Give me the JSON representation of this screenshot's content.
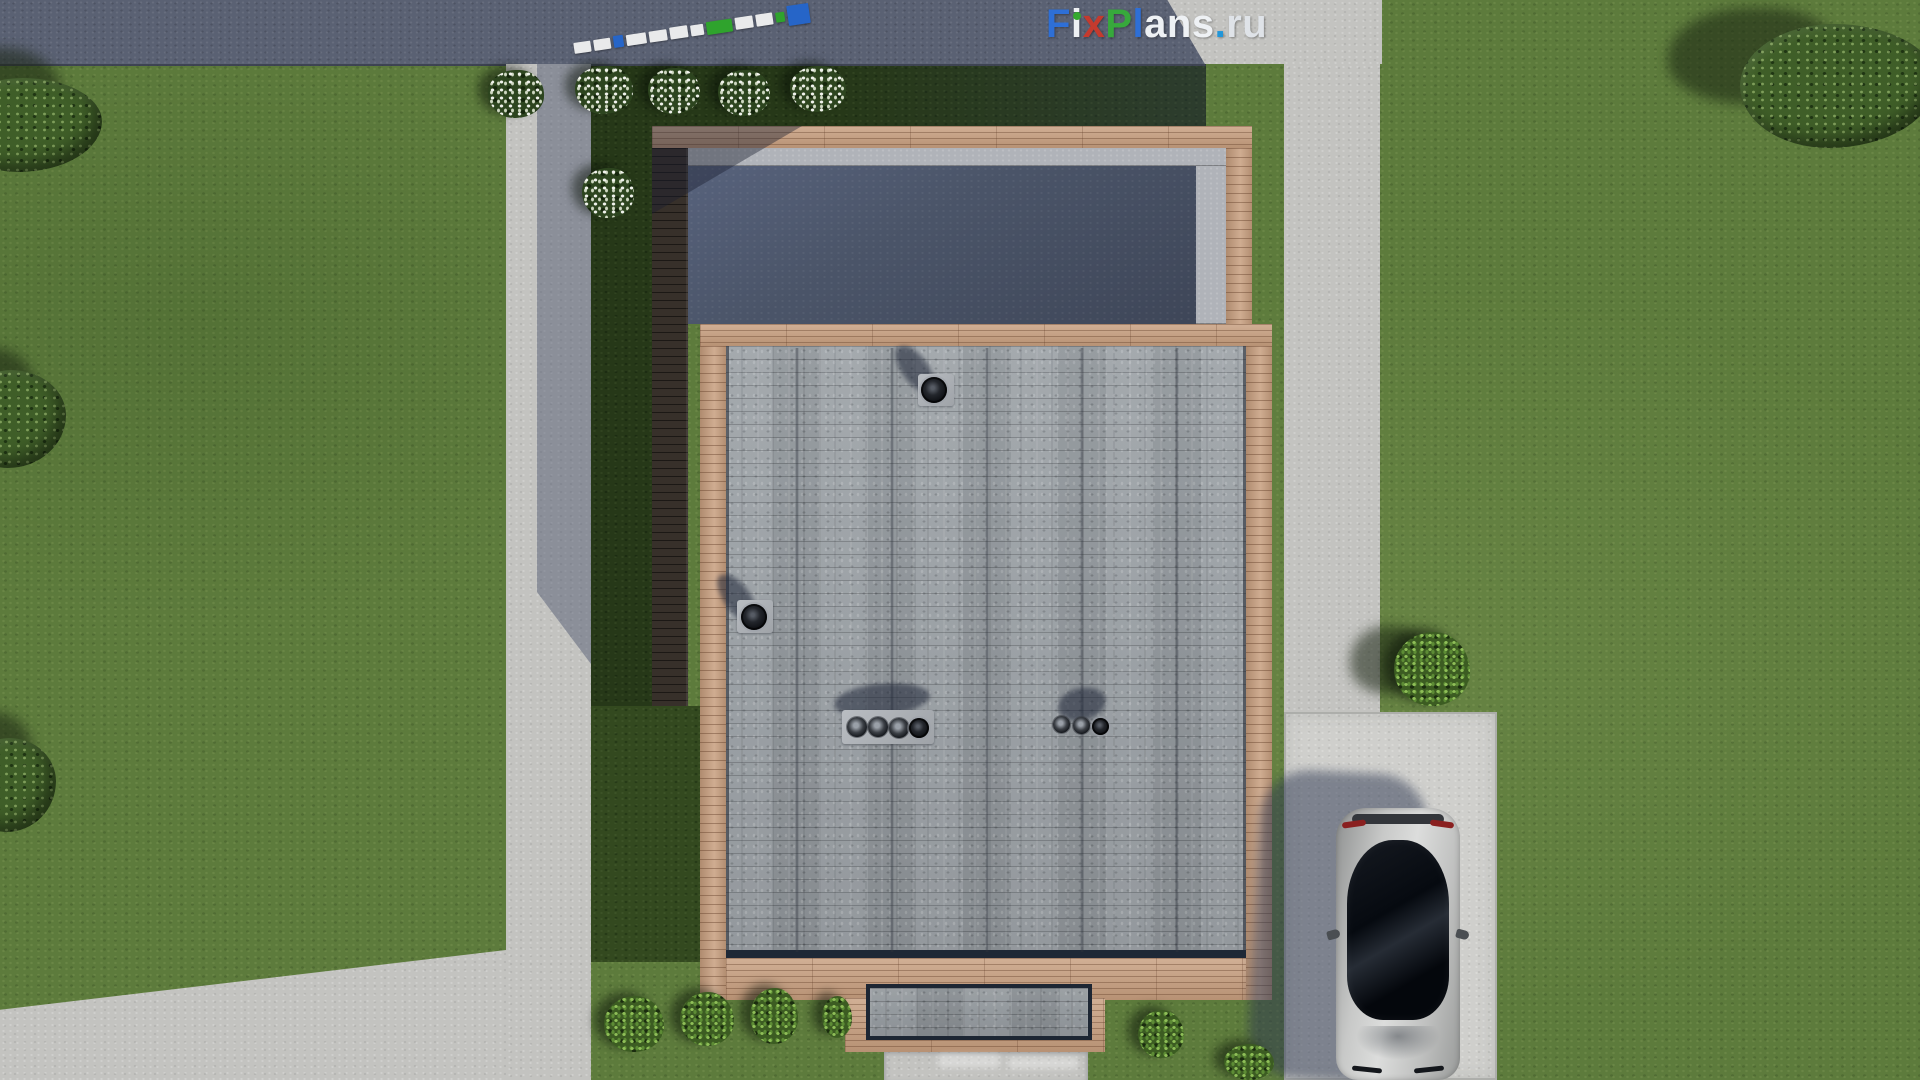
{
  "logo": {
    "text": "FixPlans.ru",
    "letters": [
      {
        "ch": "F",
        "color": "#2e6fd6"
      },
      {
        "ch": "i",
        "color": "#eef1f4"
      },
      {
        "ch": "x",
        "color": "#c43a2e"
      },
      {
        "ch": "P",
        "color": "#37a93c"
      },
      {
        "ch": "l",
        "color": "#2e6fd6"
      },
      {
        "ch": "a",
        "color": "#eef1f4"
      },
      {
        "ch": "n",
        "color": "#eef1f4"
      },
      {
        "ch": "s",
        "color": "#eef1f4"
      },
      {
        "ch": ".",
        "color": "#2196d9"
      },
      {
        "ch": "r",
        "color": "#dfe3e8"
      },
      {
        "ch": "u",
        "color": "#dfe3e8"
      }
    ],
    "i_dot_color": "#35a92f"
  },
  "palette": {
    "grass": "#5d7b3c",
    "grass-bed": "#263818",
    "grass-bed2": "#33491f",
    "road": "#5a6173",
    "pavement": "#c3c3c0",
    "driveway": "#cfcfcc",
    "wood": "#c79e7e",
    "wood-dark": "#37302a",
    "membrane-a": "#57627c",
    "membrane-b": "#3e4658",
    "parapet": "#b0b3b9",
    "shingle": "#9aa0a5",
    "roof-border": "#1e2836"
  },
  "scene": {
    "description": "Top-down 3D site render: house with gray shingle roof and dark flat roof, wood trim, lawn, concrete paths, driveway with parked silver car",
    "markers": [
      {
        "w": 17,
        "h": 11,
        "color": "#e9eaeb"
      },
      {
        "w": 17,
        "h": 11,
        "color": "#e9eaeb"
      },
      {
        "w": 10,
        "h": 12,
        "color": "#2665c8"
      },
      {
        "w": 20,
        "h": 11,
        "color": "#e9eaeb"
      },
      {
        "w": 18,
        "h": 11,
        "color": "#e9eaeb"
      },
      {
        "w": 18,
        "h": 12,
        "color": "#e9eaeb"
      },
      {
        "w": 13,
        "h": 11,
        "color": "#e9eaeb"
      },
      {
        "w": 26,
        "h": 13,
        "color": "#2fa32d"
      },
      {
        "w": 18,
        "h": 12,
        "color": "#e9eaeb"
      },
      {
        "w": 17,
        "h": 12,
        "color": "#e9eaeb"
      },
      {
        "w": 9,
        "h": 10,
        "color": "#2fa32d"
      },
      {
        "w": 22,
        "h": 20,
        "color": "#2665c8"
      }
    ],
    "sprites": [
      {
        "cls": "blob-shadow",
        "x": 1668,
        "y": 8,
        "w": 172,
        "h": 96
      },
      {
        "cls": "blob-shadow",
        "x": -72,
        "y": 48,
        "w": 132,
        "h": 86
      },
      {
        "cls": "blob-shadow",
        "x": -62,
        "y": 348,
        "w": 96,
        "h": 82
      },
      {
        "cls": "blob-shadow",
        "x": -56,
        "y": 712,
        "w": 88,
        "h": 82
      },
      {
        "cls": "blob-shadow",
        "x": 1350,
        "y": 626,
        "w": 78,
        "h": 68
      },
      {
        "cls": "tree-canopy",
        "x": 1740,
        "y": 24,
        "w": 196,
        "h": 124
      },
      {
        "cls": "tree-canopy",
        "x": -50,
        "y": 78,
        "w": 152,
        "h": 94
      },
      {
        "cls": "tree-canopy",
        "x": -40,
        "y": 370,
        "w": 106,
        "h": 98
      },
      {
        "cls": "tree-canopy",
        "x": -34,
        "y": 738,
        "w": 90,
        "h": 94
      },
      {
        "cls": "bush-green",
        "x": 1394,
        "y": 632,
        "w": 76,
        "h": 74
      },
      {
        "cls": "bush-white",
        "x": 488,
        "y": 70,
        "w": 56,
        "h": 48
      },
      {
        "cls": "bush-white",
        "x": 575,
        "y": 66,
        "w": 58,
        "h": 48
      },
      {
        "cls": "bush-white",
        "x": 648,
        "y": 68,
        "w": 52,
        "h": 46
      },
      {
        "cls": "bush-white",
        "x": 718,
        "y": 70,
        "w": 52,
        "h": 46
      },
      {
        "cls": "bush-white",
        "x": 790,
        "y": 66,
        "w": 56,
        "h": 46
      },
      {
        "cls": "bush-white",
        "x": 582,
        "y": 168,
        "w": 52,
        "h": 50
      },
      {
        "cls": "bush-green",
        "x": 604,
        "y": 996,
        "w": 60,
        "h": 56
      },
      {
        "cls": "bush-green",
        "x": 680,
        "y": 992,
        "w": 54,
        "h": 54
      },
      {
        "cls": "bush-green",
        "x": 750,
        "y": 988,
        "w": 48,
        "h": 56
      },
      {
        "cls": "bush-green",
        "x": 822,
        "y": 996,
        "w": 30,
        "h": 42
      },
      {
        "cls": "bush-green",
        "x": 1138,
        "y": 1010,
        "w": 46,
        "h": 48
      },
      {
        "cls": "bush-green",
        "x": 1224,
        "y": 1044,
        "w": 50,
        "h": 36
      },
      {
        "cls": "roof-seam",
        "x": 795,
        "y": 348,
        "w": 4,
        "h": 604
      },
      {
        "cls": "roof-seam",
        "x": 890,
        "y": 348,
        "w": 4,
        "h": 604
      },
      {
        "cls": "roof-seam",
        "x": 985,
        "y": 348,
        "w": 4,
        "h": 604
      },
      {
        "cls": "roof-seam",
        "x": 1080,
        "y": 348,
        "w": 4,
        "h": 604
      },
      {
        "cls": "roof-seam",
        "x": 1175,
        "y": 348,
        "w": 4,
        "h": 604
      },
      {
        "cls": "vent-shadow",
        "x": 902,
        "y": 342,
        "w": 26,
        "h": 54,
        "rot": -35
      },
      {
        "cls": "vent-plate",
        "x": 918,
        "y": 374,
        "w": 36,
        "h": 32
      },
      {
        "cls": "vent-ring",
        "x": 921,
        "y": 377,
        "w": 26,
        "h": 26
      },
      {
        "cls": "vent-shadow",
        "x": 724,
        "y": 570,
        "w": 26,
        "h": 56,
        "rot": -35
      },
      {
        "cls": "vent-plate",
        "x": 737,
        "y": 600,
        "w": 36,
        "h": 33
      },
      {
        "cls": "vent-ring",
        "x": 741,
        "y": 604,
        "w": 26,
        "h": 26
      },
      {
        "cls": "vent-shadow",
        "x": 834,
        "y": 684,
        "w": 96,
        "h": 32,
        "rot": -6
      },
      {
        "cls": "vent-plate",
        "x": 842,
        "y": 710,
        "w": 92,
        "h": 34
      },
      {
        "cls": "vent-ring light",
        "x": 847,
        "y": 717,
        "w": 20,
        "h": 20
      },
      {
        "cls": "vent-ring light",
        "x": 868,
        "y": 717,
        "w": 20,
        "h": 20
      },
      {
        "cls": "vent-ring light",
        "x": 889,
        "y": 718,
        "w": 20,
        "h": 20
      },
      {
        "cls": "vent-ring",
        "x": 909,
        "y": 718,
        "w": 20,
        "h": 20
      },
      {
        "cls": "vent-shadow",
        "x": 1058,
        "y": 688,
        "w": 48,
        "h": 32,
        "rot": -15
      },
      {
        "cls": "vent-ring light",
        "x": 1053,
        "y": 716,
        "w": 17,
        "h": 17
      },
      {
        "cls": "vent-ring light",
        "x": 1073,
        "y": 717,
        "w": 17,
        "h": 17
      },
      {
        "cls": "vent-ring",
        "x": 1092,
        "y": 718,
        "w": 17,
        "h": 17
      },
      {
        "cls": "logo-dot",
        "x": 1073,
        "y": 12,
        "w": 8,
        "h": 8
      },
      {
        "cls": "path-scuff",
        "x": 938,
        "y": 1054,
        "w": 62,
        "h": 14
      },
      {
        "cls": "path-scuff",
        "x": 1008,
        "y": 1057,
        "w": 70,
        "h": 12
      }
    ]
  }
}
